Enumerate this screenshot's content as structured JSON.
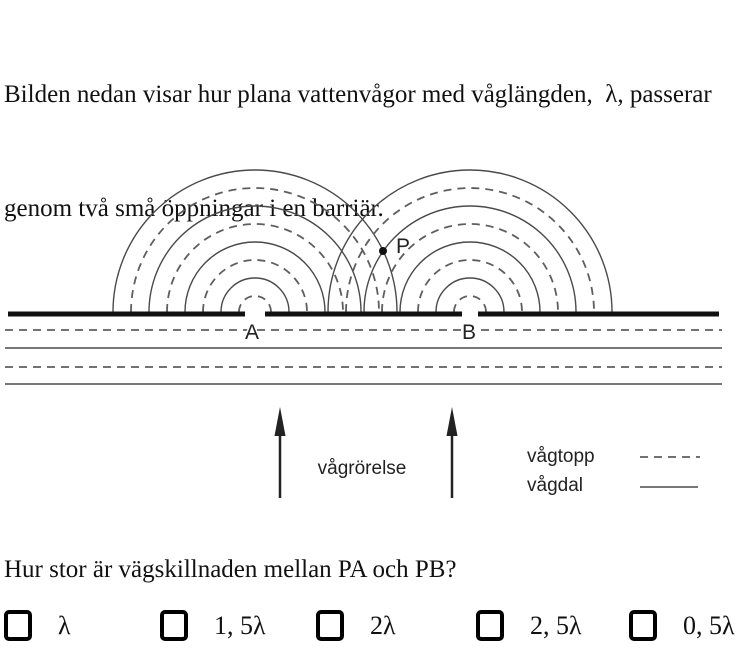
{
  "intro": {
    "line1": "Bilden nedan visar hur plana vattenvågor med våglängden,  λ, passerar",
    "line2": "genom två små öppningar i en barriär."
  },
  "diagram": {
    "barrier": {
      "y": 314,
      "x1": 8,
      "x2": 719,
      "thickness": 5,
      "gaps": [
        [
          245,
          265
        ],
        [
          462,
          478
        ]
      ]
    },
    "sources": [
      {
        "name": "A",
        "x": 255,
        "label_x": 245,
        "label_y": 339
      },
      {
        "name": "B",
        "x": 470,
        "label_x": 462,
        "label_y": 339
      }
    ],
    "arc_base_y": 312,
    "arcs": {
      "crest_dashed_radii": [
        16,
        52,
        88,
        124
      ],
      "trough_solid_radii": [
        34,
        70,
        106,
        142
      ]
    },
    "point_P": {
      "x": 383,
      "y": 251,
      "label": "P",
      "label_x": 396,
      "label_y": 253
    },
    "plane_waves": [
      {
        "y": 330,
        "style": "dashed"
      },
      {
        "y": 348,
        "style": "solid"
      },
      {
        "y": 367,
        "style": "dashed"
      },
      {
        "y": 384,
        "style": "solid"
      }
    ],
    "plane_wave_x": [
      5,
      722
    ],
    "arrows": [
      {
        "x": 280
      },
      {
        "x": 452
      }
    ],
    "arrow_y": {
      "tip": 407,
      "head_base": 436,
      "bottom": 498
    },
    "motion_label": "vågrörelse",
    "motion_label_pos": {
      "x": 362,
      "y": 474
    },
    "legend": {
      "crest_label": "vågtopp",
      "trough_label": "vågdal",
      "crest_text_pos": {
        "x": 527,
        "y": 462
      },
      "trough_text_pos": {
        "x": 527,
        "y": 491
      },
      "crest_line": {
        "x1": 640,
        "x2": 700,
        "y": 457
      },
      "trough_line": {
        "x1": 640,
        "x2": 698,
        "y": 487
      }
    },
    "colors": {
      "ink": "#111111",
      "line_solid": "#4a4a4a",
      "line_dashed": "#5e5e5e"
    }
  },
  "question": "Hur stor är vägskillnaden mellan PA och PB?",
  "options": [
    {
      "label": "λ"
    },
    {
      "label": "1, 5λ"
    },
    {
      "label": "2λ"
    },
    {
      "label": "2, 5λ"
    },
    {
      "label": "0, 5λ"
    }
  ]
}
